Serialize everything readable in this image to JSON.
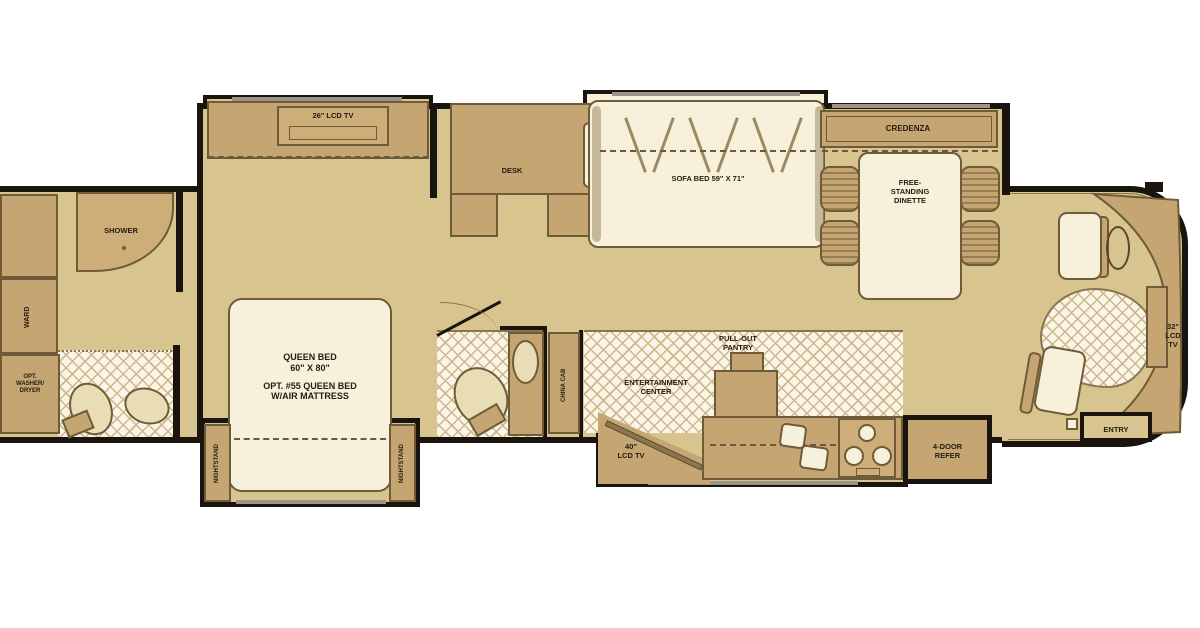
{
  "colors": {
    "floor": "#d8c48e",
    "cabinet": "#c5a673",
    "cream_fixture": "#f7f1dc",
    "wall": "#19140e",
    "hatch_line": "#cdb88c",
    "outline": "#6f5b38",
    "label_text": "#241c0e",
    "background": "#ffffff"
  },
  "rear": {
    "shower": "SHOWER",
    "ward": "WARD",
    "washer_lines": [
      "OPT.",
      "WASHER/",
      "DRYER"
    ]
  },
  "bedroom": {
    "tv": "26\" LCD TV",
    "bed_lines": [
      "QUEEN BED",
      "60\" X 80\"",
      "OPT. #55 QUEEN BED",
      "W/AIR MATTRESS"
    ],
    "nightstand": "NIGHTSTAND"
  },
  "midbath": {
    "china_cab": "CHINA CAB"
  },
  "office": {
    "desk": "DESK"
  },
  "living": {
    "sofa": "SOFA BED 59\" X 71\"",
    "credenza": "CREDENZA",
    "dinette_lines": [
      "FREE-",
      "STANDING",
      "DINETTE"
    ]
  },
  "kitchen": {
    "ent_lines": [
      "ENTERTAINMENT",
      "CENTER"
    ],
    "pantry_lines": [
      "PULL-OUT",
      "PANTRY"
    ],
    "tv_lines": [
      "40\"",
      "LCD TV"
    ],
    "refer_lines": [
      "4-DOOR",
      "REFER"
    ]
  },
  "front": {
    "entry": "ENTRY",
    "tv_lines": [
      "32\"",
      "LCD",
      "TV"
    ]
  }
}
